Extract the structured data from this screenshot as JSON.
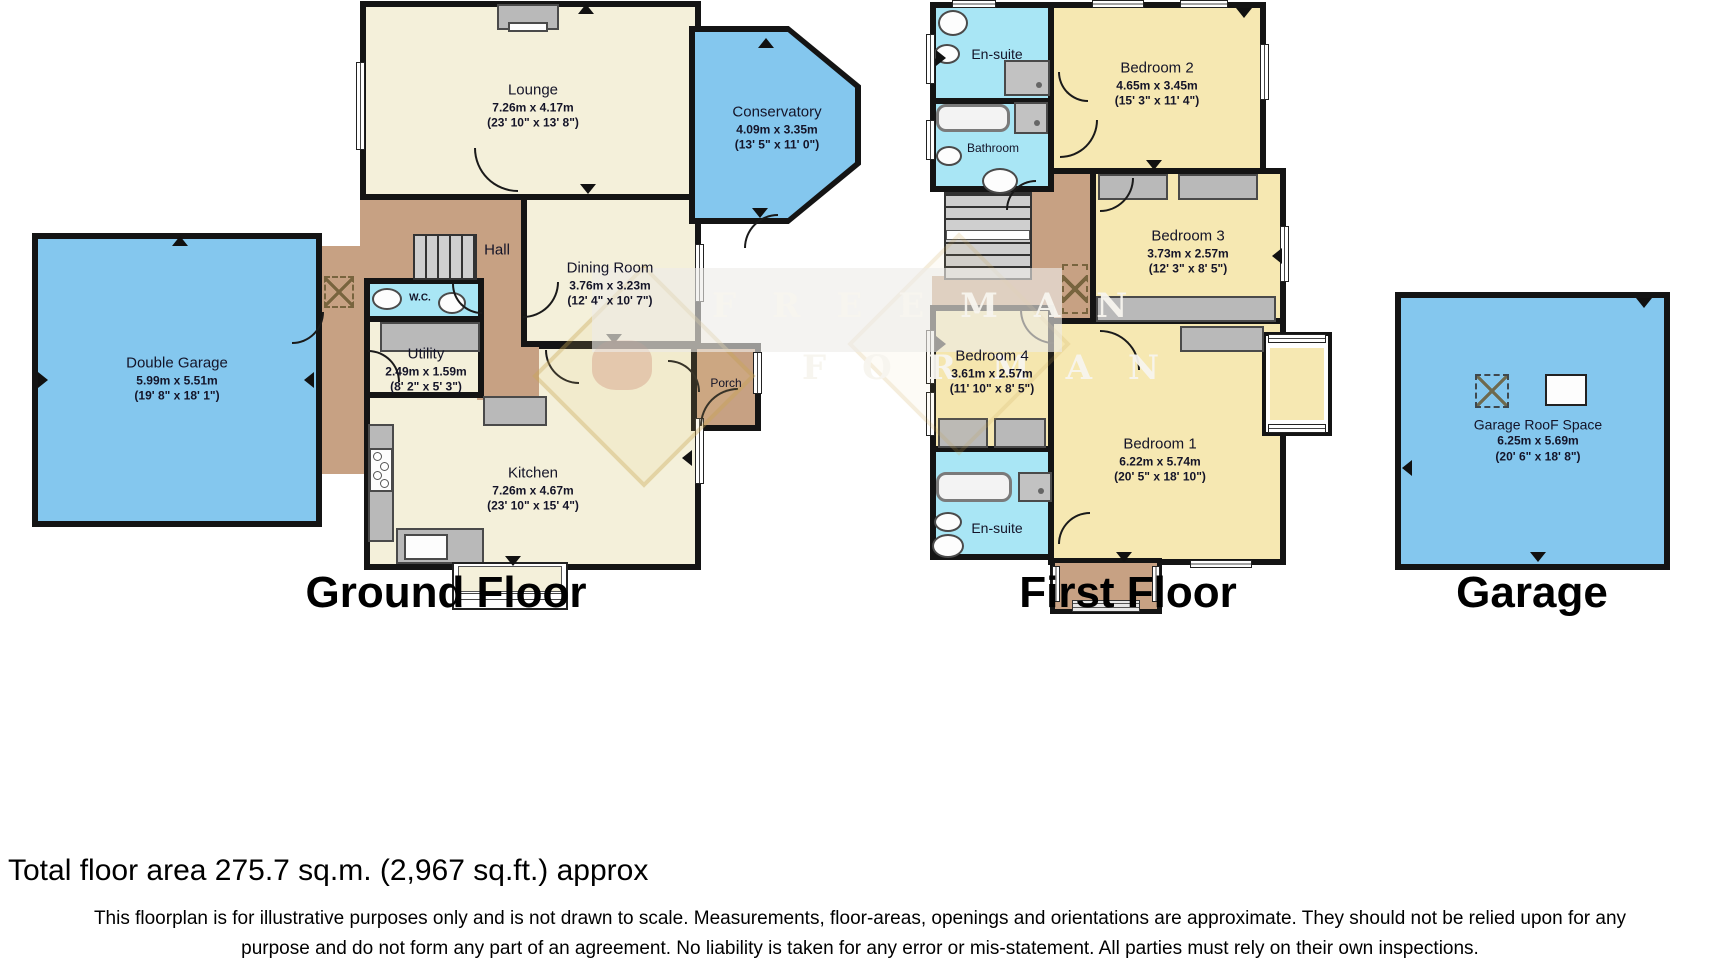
{
  "floors": {
    "ground": {
      "label": "Ground Floor",
      "rooms": {
        "lounge": {
          "name": "Lounge",
          "metric": "7.26m x 4.17m",
          "imperial": "(23' 10\" x 13' 8\")"
        },
        "conservatory": {
          "name": "Conservatory",
          "metric": "4.09m x 3.35m",
          "imperial": "(13' 5\" x 11' 0\")"
        },
        "hall": {
          "name": "Hall"
        },
        "dining": {
          "name": "Dining Room",
          "metric": "3.76m x 3.23m",
          "imperial": "(12' 4\" x 10' 7\")"
        },
        "wc": {
          "name": "W.C."
        },
        "utility": {
          "name": "Utility",
          "metric": "2.49m x 1.59m",
          "imperial": "(8' 2\" x 5' 3\")"
        },
        "kitchen": {
          "name": "Kitchen",
          "metric": "7.26m x 4.67m",
          "imperial": "(23' 10\" x 15' 4\")"
        },
        "porch": {
          "name": "Porch"
        },
        "garage": {
          "name": "Double Garage",
          "metric": "5.99m x 5.51m",
          "imperial": "(19' 8\" x 18' 1\")"
        }
      }
    },
    "first": {
      "label": "First Floor",
      "rooms": {
        "ensuite_top": {
          "name": "En-suite"
        },
        "bathroom": {
          "name": "Bathroom"
        },
        "bedroom2": {
          "name": "Bedroom 2",
          "metric": "4.65m x 3.45m",
          "imperial": "(15' 3\" x 11' 4\")"
        },
        "bedroom3": {
          "name": "Bedroom 3",
          "metric": "3.73m x 2.57m",
          "imperial": "(12' 3\" x 8' 5\")"
        },
        "bedroom4": {
          "name": "Bedroom 4",
          "metric": "3.61m x 2.57m",
          "imperial": "(11' 10\" x 8' 5\")"
        },
        "bedroom1": {
          "name": "Bedroom 1",
          "metric": "6.22m x 5.74m",
          "imperial": "(20' 5\" x 18' 10\")"
        },
        "ensuite_bottom": {
          "name": "En-suite"
        }
      }
    },
    "garage_floor": {
      "label": "Garage",
      "rooms": {
        "roof_space": {
          "name": "Garage RooF Space",
          "metric": "6.25m x 5.69m",
          "imperial": "(20' 6\" x 18' 8\")"
        }
      }
    }
  },
  "watermark": {
    "line1": "FREEMAN",
    "line2": "FORMAN"
  },
  "footer": {
    "total_area": "Total floor area 275.7 sq.m. (2,967 sq.ft.) approx",
    "disclaimer_line1": "This floorplan is for illustrative purposes only and is not drawn to scale. Measurements, floor-areas, openings and orientations are approximate. They should not be relied upon for any",
    "disclaimer_line2": "purpose and do not form any part of an agreement. No liability is taken for any error or mis-statement. All parties must rely on their own inspections."
  },
  "colors": {
    "room_cream": "#f4f0da",
    "room_yellow": "#f6e8b2",
    "room_blue": "#84c7ee",
    "room_cyan": "#a9e6f5",
    "room_tan": "#c7a183",
    "wall": "#141414",
    "fixture_gray": "#b9b9b9"
  }
}
